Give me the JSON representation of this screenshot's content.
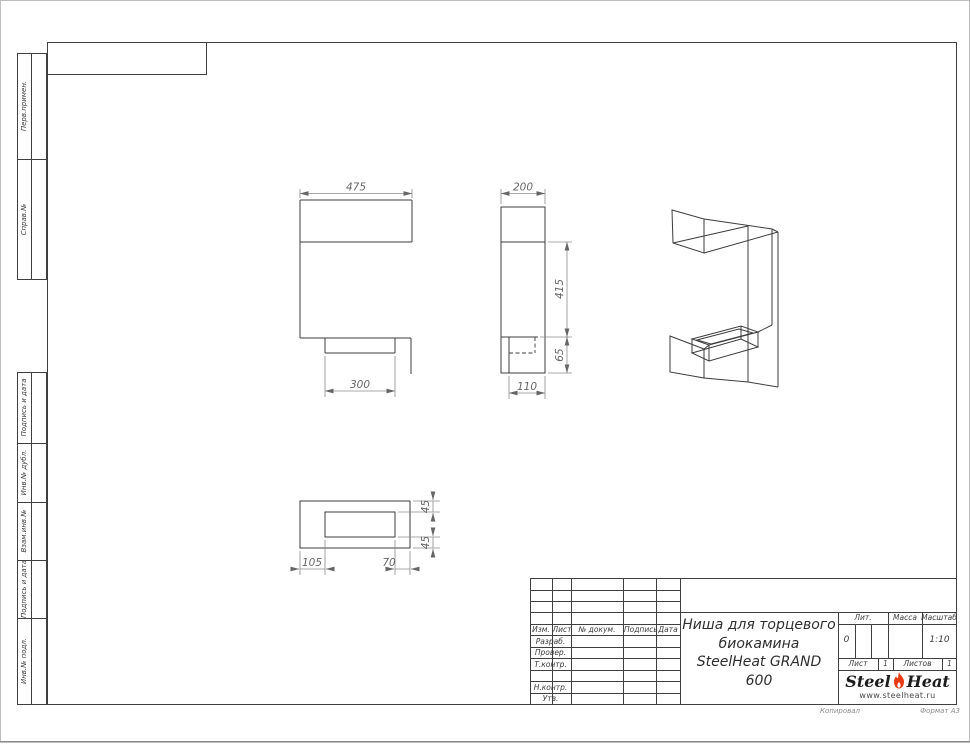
{
  "sheet": {
    "footer_left": "Копировал",
    "footer_right": "Формат А3"
  },
  "sidebar": {
    "top": [
      {
        "label": "Перв.примен."
      },
      {
        "label": "Справ.№"
      }
    ],
    "bottom": [
      {
        "label": "Подпись и дата"
      },
      {
        "label": "Инв.№ дубл."
      },
      {
        "label": "Взам.инв.№"
      },
      {
        "label": "Подпись и дата"
      },
      {
        "label": "Инв.№ подл."
      }
    ]
  },
  "views": {
    "front": {
      "width": "475",
      "slot": "300"
    },
    "side": {
      "depth": "200",
      "height": "415",
      "bottom_height": "65",
      "slot_depth": "110"
    },
    "bottom": {
      "left_offset": "105",
      "right_offset": "70",
      "top_offset": "45",
      "bottom_offset": "45"
    }
  },
  "title_block": {
    "cols": {
      "izm": "Изм.",
      "list": "Лист",
      "doc": "№ докум.",
      "sign": "Подпись",
      "date": "Дата"
    },
    "rows": {
      "razrab": "Разраб.",
      "prover": "Провер.",
      "tkontr": "Т.контр.",
      "nkontr": "Н.контр.",
      "utv": "Утв."
    },
    "title_line1": "Ниша для торцевого",
    "title_line2": "биокамина",
    "title_line3": "SteelHeat GRAND 600",
    "lit_label": "Лит.",
    "lit_value": "0",
    "mass_label": "Масса",
    "scale_label": "Масштаб",
    "scale_value": "1:10",
    "sheet_label": "Лист",
    "sheet_value": "1",
    "sheets_label": "Листов",
    "sheets_value": "1",
    "logo": {
      "part1": "Steel",
      "part2": "Heat",
      "url": "www.steelheat.ru"
    }
  },
  "colors": {
    "flame_red": "#e63b11",
    "line": "#3c3c3c",
    "dim_text": "#666666"
  }
}
